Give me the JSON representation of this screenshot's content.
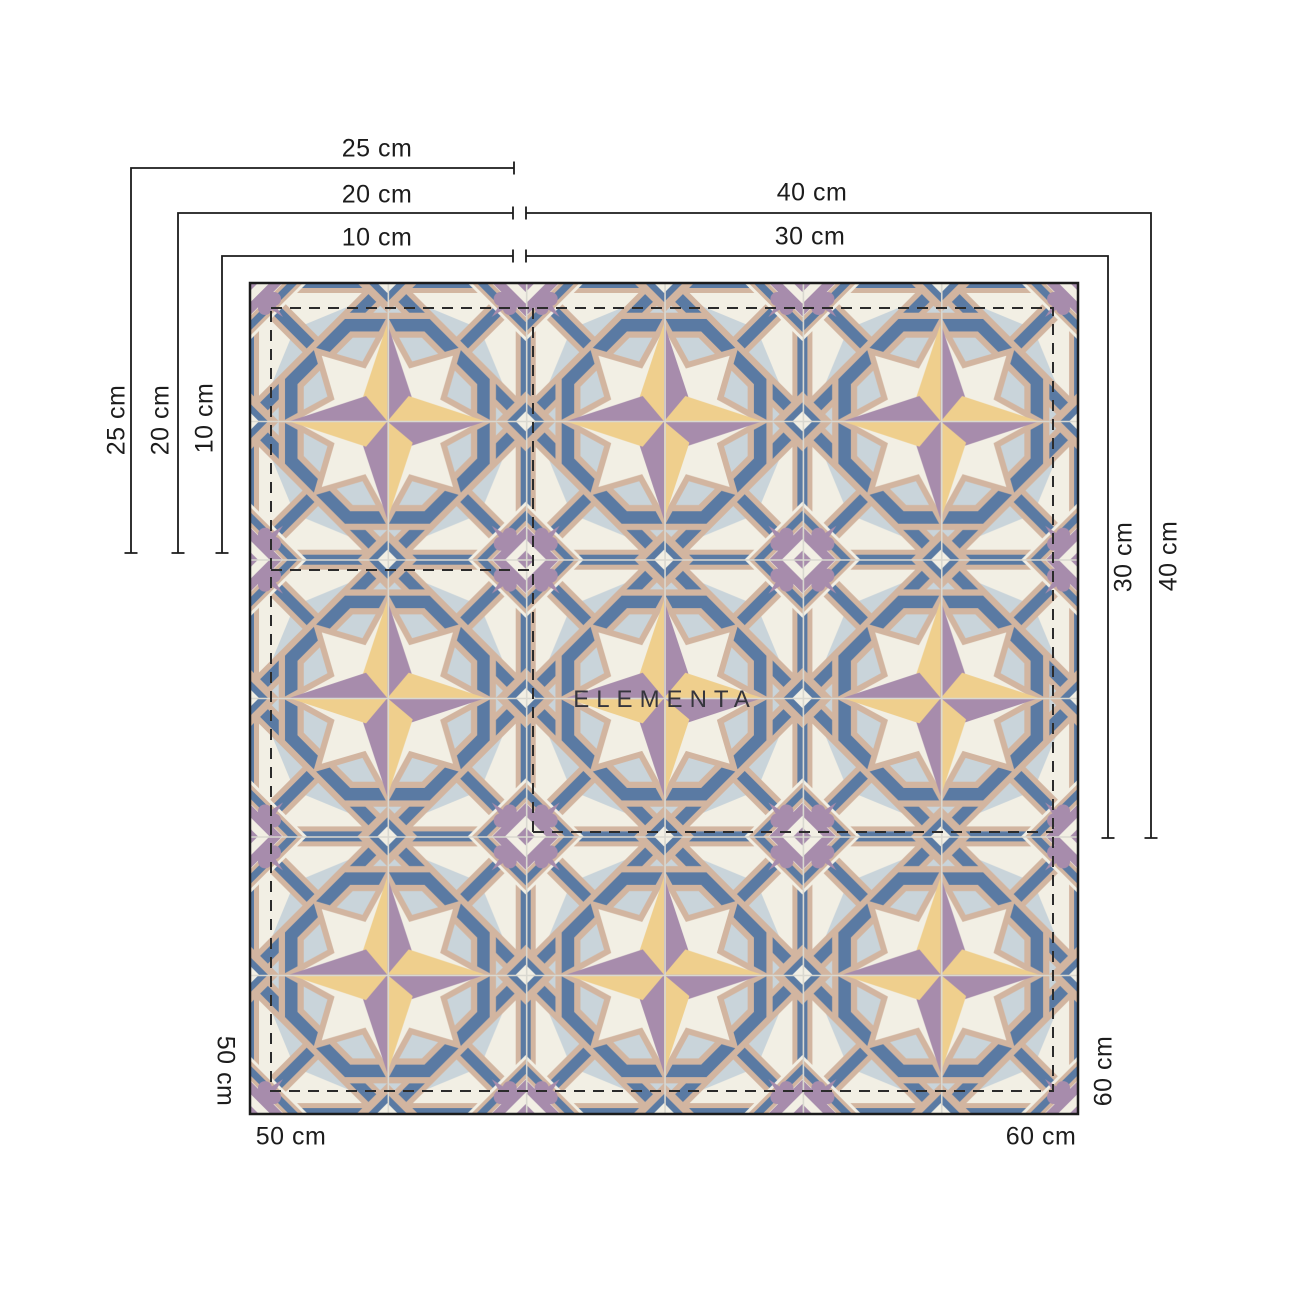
{
  "brand": {
    "wordmark": "ELEMENTA"
  },
  "dimension_labels": {
    "d10": "10 cm",
    "d20": "20 cm",
    "d25": "25 cm",
    "d30": "30 cm",
    "d40": "40 cm",
    "d50": "50 cm",
    "d60": "60 cm"
  },
  "palette": {
    "cream": "#F2EFE4",
    "light_blue": "#C9D4DA",
    "blue": "#5A7AA3",
    "tan": "#D2B5A0",
    "purple": "#A78CAC",
    "yellow": "#EFCF8D",
    "joint": "#D9D8D0",
    "line": "#1B1B1B",
    "dash": "#2B2B2B"
  }
}
